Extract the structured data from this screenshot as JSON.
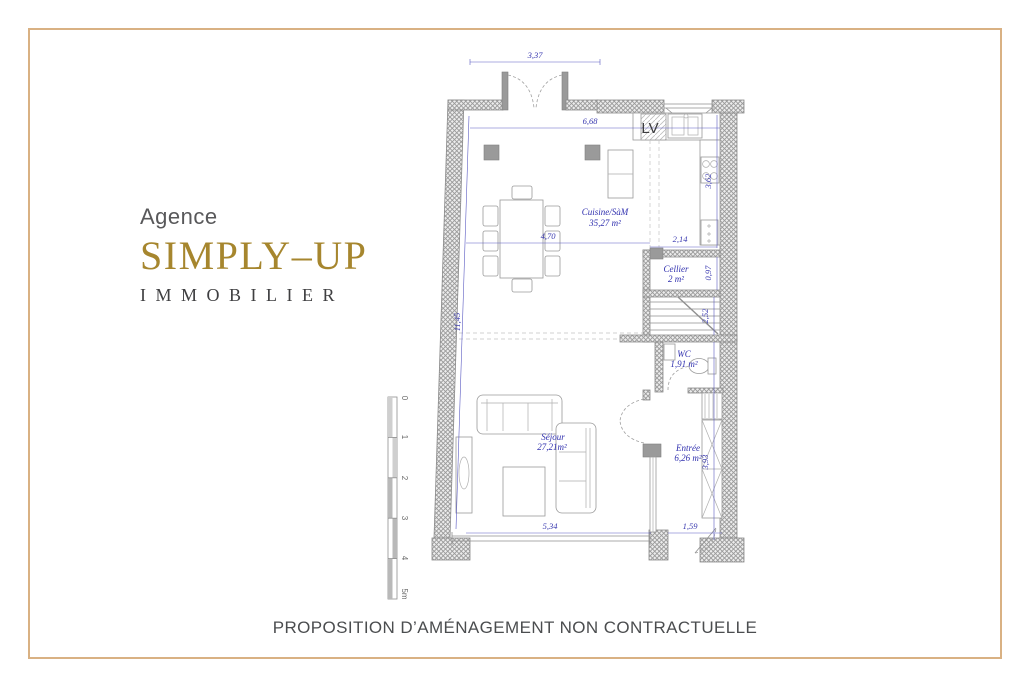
{
  "page": {
    "border_color": "#d9b183",
    "background": "#ffffff"
  },
  "logo": {
    "prefix": "Agence",
    "brand": "SIMPLY–UP",
    "subtitle": "IMMOBILIER",
    "brand_color": "#a6862e"
  },
  "caption": "PROPOSITION D’AMÉNAGEMENT NON CONTRACTUELLE",
  "floorplan": {
    "labels": {
      "dishwasher": "LV"
    },
    "rooms": {
      "cuisine": {
        "name": "Cuisine/SàM",
        "area": "35,27 m²"
      },
      "cellier": {
        "name": "Cellier",
        "area": "2 m²"
      },
      "wc": {
        "name": "WC",
        "area": "1,91 m²"
      },
      "entree": {
        "name": "Entrée",
        "area": "6,26 m²"
      },
      "sejour": {
        "name": "Séjour",
        "area": "27,21m²"
      }
    },
    "dimensions": {
      "top_opening": "3,37",
      "kitchen_width": "6,68",
      "dining_span": "4,70",
      "kitchen_return": "2,14",
      "kitchen_right": "3,62",
      "cellier_depth": "0,97",
      "stairs": "2,52",
      "left_height": "11,45",
      "entree_height": "3,93",
      "sejour_width": "5,34",
      "entry_door": "1,59"
    },
    "scale_bar": [
      "0",
      "1",
      "2",
      "3",
      "4",
      "5m"
    ],
    "dim_color": "#3a3ab0"
  }
}
